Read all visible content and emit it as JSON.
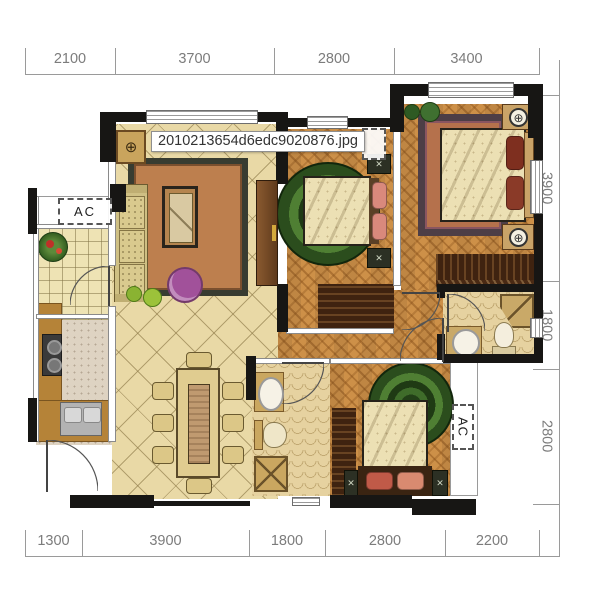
{
  "tooltip": {
    "filename": "2010213654d6edc9020876.jpg"
  },
  "dimensions": {
    "top": [
      "2100",
      "3700",
      "2800",
      "3400"
    ],
    "bottom": [
      "1300",
      "3900",
      "1800",
      "2800",
      "2200"
    ],
    "right": [
      "3900",
      "1800",
      "2800"
    ]
  },
  "labels": {
    "ac_left": "AC",
    "ac_right": "AC"
  },
  "icons": {
    "lamp": "⊕",
    "cross": "✕",
    "cabinet_motif": "⊕"
  },
  "colors": {
    "wall": "#171614",
    "wood_floor": "#cd9048",
    "tile_floor": "#e9d9a6",
    "rug_green": "#2b4d1d",
    "rug_living": "#bd7f4e",
    "ottoman_purple": "#a1519a",
    "counter": "#b58338",
    "dimension_text": "#7c7c7c"
  }
}
